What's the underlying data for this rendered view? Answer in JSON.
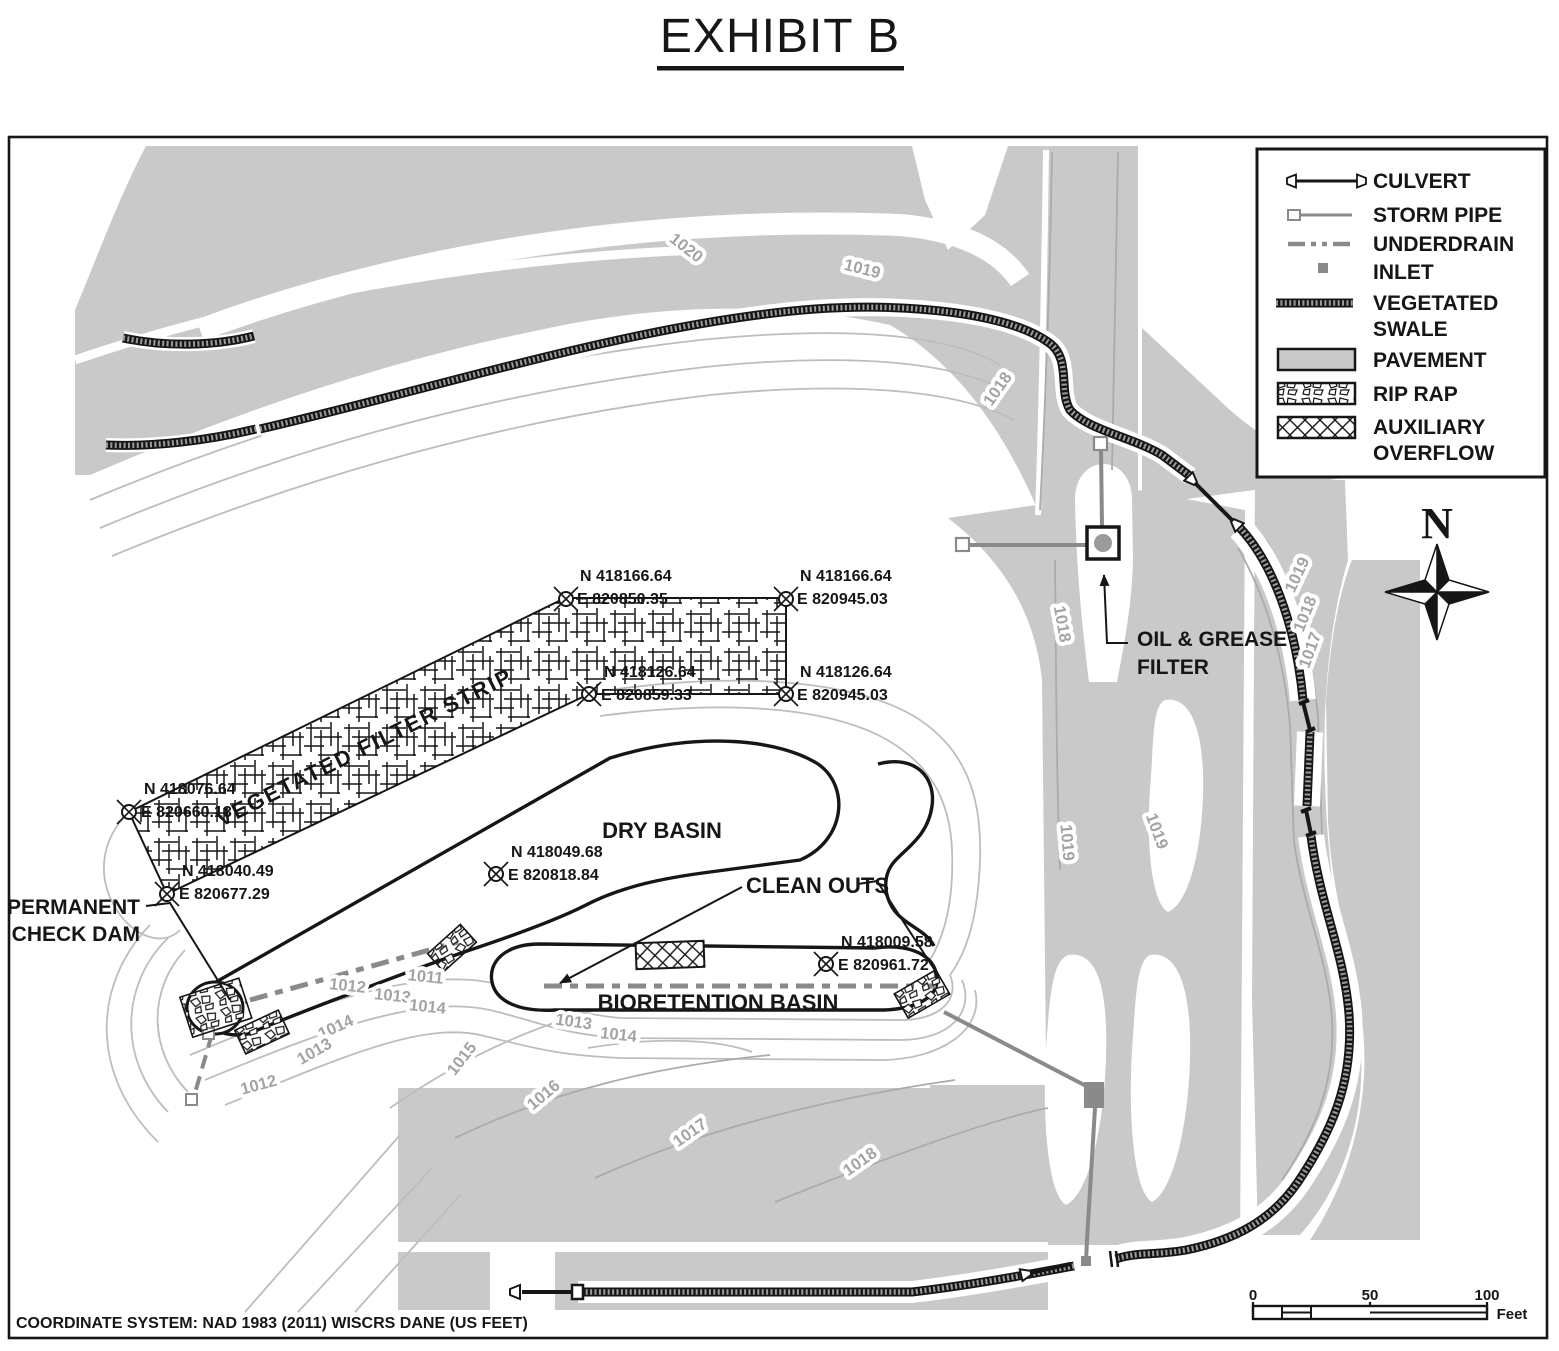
{
  "title": "EXHIBIT B",
  "footer": "COORDINATE SYSTEM: NAD 1983 (2011) WISCRS DANE (US FEET)",
  "legend": {
    "items": [
      {
        "name": "culvert",
        "lines": [
          "CULVERT"
        ]
      },
      {
        "name": "storm-pipe",
        "lines": [
          "STORM PIPE"
        ]
      },
      {
        "name": "underdrain",
        "lines": [
          "UNDERDRAIN"
        ]
      },
      {
        "name": "inlet",
        "lines": [
          "INLET"
        ]
      },
      {
        "name": "vegetated-swale",
        "lines": [
          "VEGETATED",
          "SWALE"
        ]
      },
      {
        "name": "pavement",
        "lines": [
          "PAVEMENT"
        ]
      },
      {
        "name": "rip-rap",
        "lines": [
          "RIP RAP"
        ]
      },
      {
        "name": "auxiliary-overflow",
        "lines": [
          "AUXILIARY",
          "OVERFLOW"
        ]
      }
    ]
  },
  "north_arrow_label": "N",
  "scale_bar": {
    "ticks": [
      "0",
      "50",
      "100"
    ],
    "unit": "Feet"
  },
  "labels": {
    "filter_strip": "VEGETATED FILTER STRIP",
    "dry_basin": "DRY BASIN",
    "clean_outs": "CLEAN OUTS",
    "bioretention": "BIORETENTION BASIN",
    "check_dam": [
      "PERMANENT",
      "CHECK DAM"
    ],
    "oil_filter": [
      "OIL & GREASE",
      "FILTER"
    ]
  },
  "survey_points": [
    {
      "n": "N 418166.64",
      "e": "E 820850.35"
    },
    {
      "n": "N 418166.64",
      "e": "E 820945.03"
    },
    {
      "n": "N 418126.64",
      "e": "E 820859.33"
    },
    {
      "n": "N 418126.64",
      "e": "E 820945.03"
    },
    {
      "n": "N 418076.64",
      "e": "E 820660.18"
    },
    {
      "n": "N 418040.49",
      "e": "E 820677.29"
    },
    {
      "n": "N 418049.68",
      "e": "E 820818.84"
    },
    {
      "n": "N 418009.58",
      "e": "E 820961.72"
    }
  ],
  "contour_labels": [
    "1020",
    "1019",
    "1018",
    "1018",
    "1019",
    "1019",
    "1019",
    "1018",
    "1017",
    "1011",
    "1012",
    "1013",
    "1014",
    "1014",
    "1013",
    "1012",
    "1015",
    "1013",
    "1014",
    "1016",
    "1017",
    "1018"
  ],
  "colors": {
    "pavement": "#c9c9c9",
    "contour_gray": "#bdbdbd",
    "contour_gray_on_pavement": "#ababab",
    "pipe_gray": "#8a8a8a",
    "ink": "#161616",
    "contour_label_gray": "#a3a3a3"
  }
}
